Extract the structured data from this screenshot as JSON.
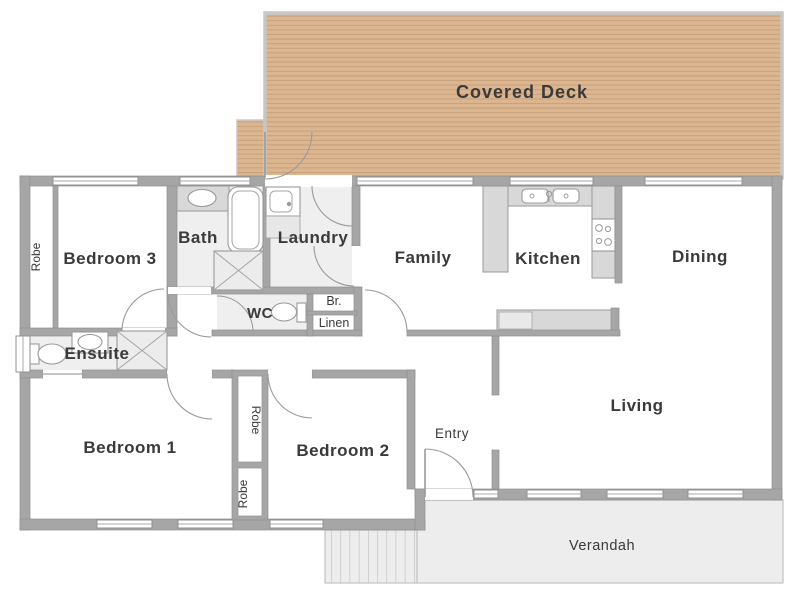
{
  "rooms": {
    "covered_deck": {
      "label": "Covered Deck"
    },
    "bedroom3": {
      "label": "Bedroom 3"
    },
    "bath": {
      "label": "Bath"
    },
    "laundry": {
      "label": "Laundry"
    },
    "family": {
      "label": "Family"
    },
    "kitchen": {
      "label": "Kitchen"
    },
    "dining": {
      "label": "Dining"
    },
    "living": {
      "label": "Living"
    },
    "wc": {
      "label": "WC"
    },
    "br": {
      "label": "Br."
    },
    "linen": {
      "label": "Linen"
    },
    "ensuite": {
      "label": "Ensuite"
    },
    "bedroom1": {
      "label": "Bedroom 1"
    },
    "bedroom2": {
      "label": "Bedroom 2"
    },
    "entry": {
      "label": "Entry"
    },
    "verandah": {
      "label": "Verandah"
    },
    "robe_bed3": {
      "label": "Robe"
    },
    "robe_top": {
      "label": "Robe"
    },
    "robe_bottom": {
      "label": "Robe"
    }
  },
  "colors": {
    "deck_fill": "#dbb691",
    "deck_border": "#c6c6c6",
    "wall": "#a6a6a6",
    "wet_floor": "#efefef",
    "counter": "#d8d8d8",
    "appliance": "#e9e9e9",
    "verandah_fill": "#ededed",
    "verandah_border": "#c6c6c6",
    "label_text": "#3a3a3a"
  }
}
